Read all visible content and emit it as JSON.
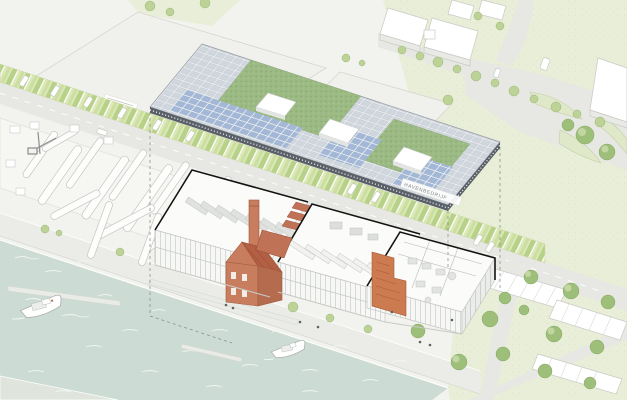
{
  "scene": {
    "description": "axonometric-harbor-site-plan-with-exploded-roof",
    "road_label": "HAVENBEDRIJF"
  },
  "palette": {
    "water": "#ccdbd3",
    "grass": "#e9eed8",
    "road": "#e7e7e3",
    "paved": "#f2f2ee",
    "roof_panel": "#cfd6dd",
    "roof_solar": "#a3b8d6",
    "roof_green": "#9cba84",
    "brick": "#c87e5e",
    "stair_accent": "#cc7a50",
    "tree": "#a3c47e",
    "cut_outline": "#141414"
  },
  "inventory": {
    "boats_in_water": 2,
    "roof_skylights": 3,
    "building_wings": 3,
    "house_rows": 3
  }
}
